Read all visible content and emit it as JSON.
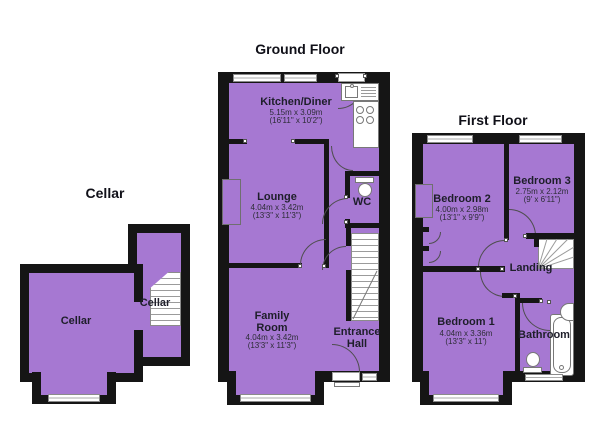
{
  "palette": {
    "room_fill": "#a678d2",
    "wall": "#151515",
    "background": "#ffffff"
  },
  "floors": {
    "cellar": {
      "title": "Cellar",
      "rooms": {
        "cellar_main": {
          "label": "Cellar"
        },
        "cellar_stairs": {
          "label": "Cellar"
        }
      }
    },
    "ground": {
      "title": "Ground Floor",
      "rooms": {
        "kitchen_diner": {
          "label": "Kitchen/Diner",
          "size_metric": "5.15m x 3.09m",
          "size_imperial": "(16'11\" x 10'2\")"
        },
        "lounge": {
          "label": "Lounge",
          "size_metric": "4.04m x 3.42m",
          "size_imperial": "(13'3\" x 11'3\")"
        },
        "family_room": {
          "label": "Family Room",
          "size_metric": "4.04m x 3.42m",
          "size_imperial": "(13'3\" x 11'3\")"
        },
        "wc": {
          "label": "WC"
        },
        "entrance_hall": {
          "label": "Entrance Hall"
        }
      }
    },
    "first": {
      "title": "First Floor",
      "rooms": {
        "bedroom_1": {
          "label": "Bedroom 1",
          "size_metric": "4.04m x 3.36m",
          "size_imperial": "(13'3\" x 11')"
        },
        "bedroom_2": {
          "label": "Bedroom 2",
          "size_metric": "4.00m x 2.98m",
          "size_imperial": "(13'1\" x 9'9\")"
        },
        "bedroom_3": {
          "label": "Bedroom 3",
          "size_metric": "2.75m x 2.12m",
          "size_imperial": "(9' x 6'11\")"
        },
        "landing": {
          "label": "Landing"
        },
        "bathroom": {
          "label": "Bathroom"
        }
      }
    }
  }
}
